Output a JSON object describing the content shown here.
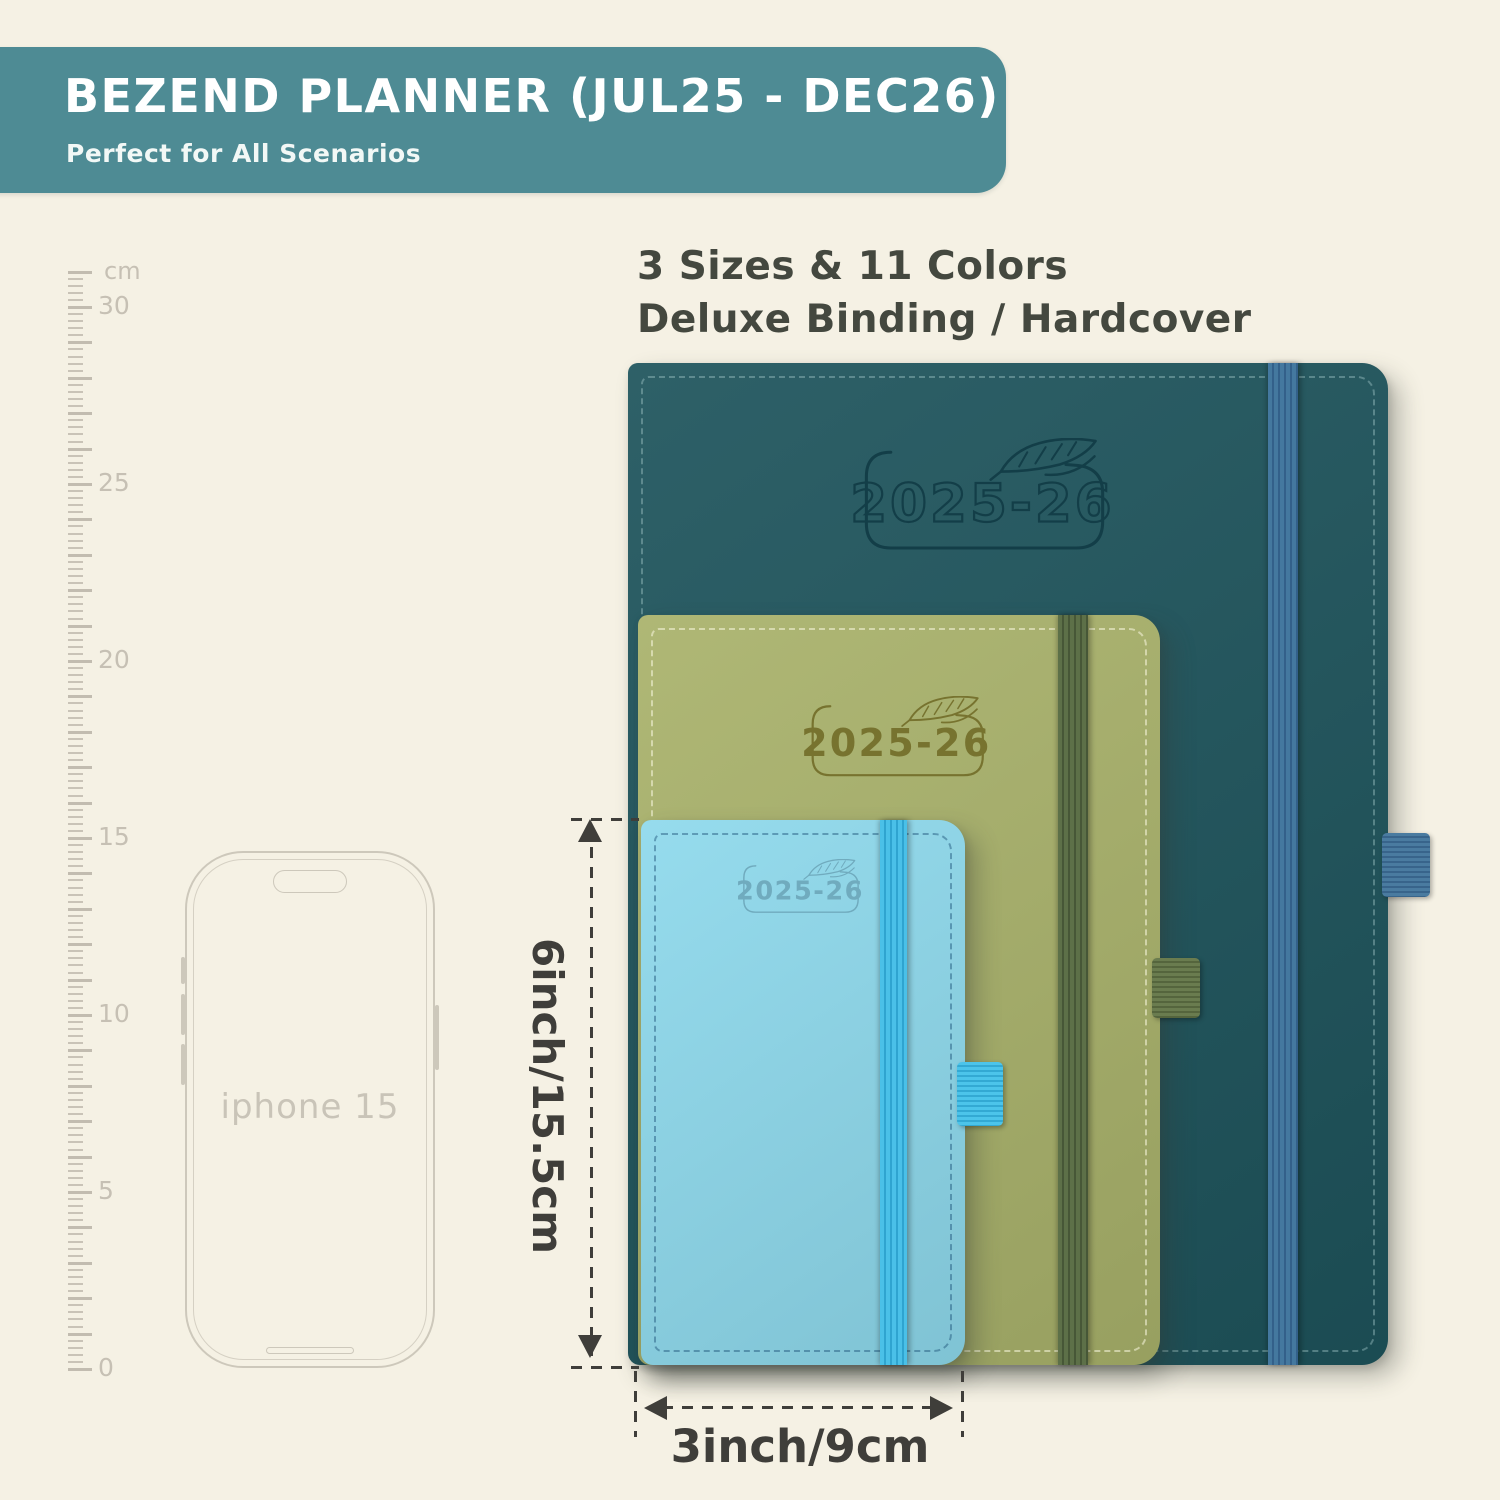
{
  "banner": {
    "title": "BEZEND PLANNER (JUL25 - DEC26)",
    "subtitle": "Perfect for All Scenarios",
    "background": "#4e8b94",
    "text_color": "#ffffff"
  },
  "headline": {
    "line1": "3 Sizes & 11 Colors",
    "line2": "Deluxe Binding / Hardcover"
  },
  "ruler": {
    "unit": "cm",
    "labeled_values": [
      30,
      25,
      20,
      15,
      10,
      5,
      0
    ],
    "max_cm": 31,
    "px_per_cm": 35.4,
    "bottom_y": 1368,
    "color": "#c6c0b4"
  },
  "phone": {
    "label": "iphone 15",
    "outline_color": "#cdc8bb"
  },
  "planners": [
    {
      "name": "large",
      "cover_text": "2025-26",
      "engrave": "outline",
      "colors": {
        "cover": "#1e545c",
        "emboss": "#123d47",
        "stitch": "rgba(175,210,210,0.45)",
        "band1": "#44789f",
        "band2": "#33608a",
        "loop1": "#4a7ba0",
        "loop2": "#38648b"
      }
    },
    {
      "name": "medium",
      "cover_text": "2025-26",
      "engrave": "fill",
      "colors": {
        "cover": "#a9b26b",
        "emboss": "#75702c",
        "stitch": "rgba(248,246,222,0.65)",
        "band1": "#5d7048",
        "band2": "#475737",
        "loop1": "#6a7c4f",
        "loop2": "#55653d"
      }
    },
    {
      "name": "small",
      "cover_text": "2025-26",
      "engrave": "fill",
      "colors": {
        "cover": "#8ed9ec",
        "emboss": "#6fa9bc",
        "stitch": "rgba(21,72,112,0.5)",
        "band1": "#4ac0e8",
        "band2": "#2fa4d0",
        "loop1": "#4cc4ea",
        "loop2": "#33a9d3"
      }
    }
  ],
  "dimensions": {
    "height_label": "6inch/15.5cm",
    "width_label": "3inch/9cm",
    "line_color": "#3f3e3a"
  },
  "colors": {
    "background": "#f5f1e4"
  }
}
